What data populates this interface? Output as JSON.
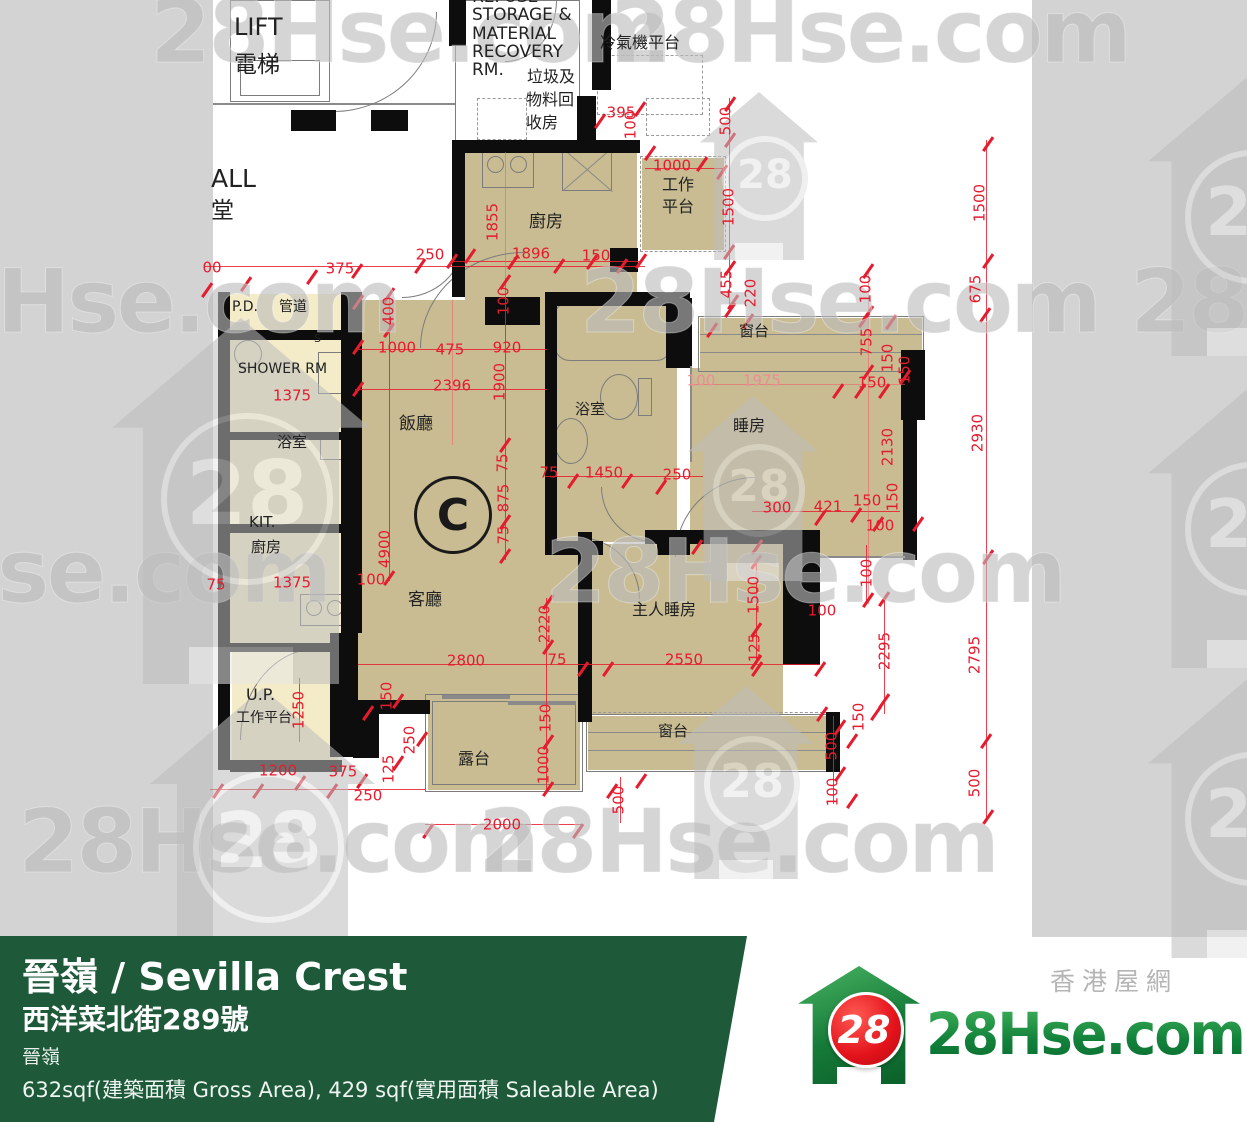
{
  "watermark": {
    "text": "28Hse.com",
    "logo_number": "28"
  },
  "plan": {
    "unit": "C",
    "labels": [
      {
        "t": "LIFT",
        "x": 234,
        "y": 14,
        "s": 24
      },
      {
        "t": "電梯",
        "x": 234,
        "y": 52,
        "s": 23
      },
      {
        "t": "ALL",
        "x": 211,
        "y": 165,
        "s": 25
      },
      {
        "t": "堂",
        "x": 211,
        "y": 198,
        "s": 23
      },
      {
        "t": "REFUSE",
        "x": 472,
        "y": -12,
        "s": 17
      },
      {
        "t": "STORAGE &",
        "x": 472,
        "y": 6,
        "s": 17
      },
      {
        "t": "MATERIAL",
        "x": 472,
        "y": 25,
        "s": 17
      },
      {
        "t": "RECOVERY",
        "x": 472,
        "y": 43,
        "s": 17
      },
      {
        "t": "RM.",
        "x": 472,
        "y": 61,
        "s": 17
      },
      {
        "t": "垃圾及",
        "x": 527,
        "y": 68,
        "s": 16
      },
      {
        "t": "物料回",
        "x": 526,
        "y": 91,
        "s": 16
      },
      {
        "t": "收房",
        "x": 526,
        "y": 114,
        "s": 16
      },
      {
        "t": "冷氣機平台",
        "x": 600,
        "y": 34,
        "s": 16
      },
      {
        "t": "廚房",
        "x": 529,
        "y": 213,
        "s": 17
      },
      {
        "t": "工作",
        "x": 662,
        "y": 176,
        "s": 16
      },
      {
        "t": "平台",
        "x": 662,
        "y": 198,
        "s": 16
      },
      {
        "t": "P.D.",
        "x": 232,
        "y": 299,
        "s": 14
      },
      {
        "t": "管道",
        "x": 279,
        "y": 299,
        "s": 14
      },
      {
        "t": "SHOWER RM",
        "x": 238,
        "y": 361,
        "s": 14
      },
      {
        "t": "浴室",
        "x": 277,
        "y": 434,
        "s": 15
      },
      {
        "t": "KIT.",
        "x": 249,
        "y": 514,
        "s": 15
      },
      {
        "t": "廚房",
        "x": 251,
        "y": 539,
        "s": 15
      },
      {
        "t": "U.P.",
        "x": 246,
        "y": 686,
        "s": 16
      },
      {
        "t": "工作平台",
        "x": 236,
        "y": 710,
        "s": 14
      },
      {
        "t": "飯廳",
        "x": 399,
        "y": 415,
        "s": 17
      },
      {
        "t": "客廳",
        "x": 408,
        "y": 591,
        "s": 17
      },
      {
        "t": "浴室",
        "x": 575,
        "y": 401,
        "s": 15
      },
      {
        "t": "睡房",
        "x": 733,
        "y": 417,
        "s": 16
      },
      {
        "t": "窗台",
        "x": 739,
        "y": 323,
        "s": 15
      },
      {
        "t": "主人睡房",
        "x": 632,
        "y": 601,
        "s": 16
      },
      {
        "t": "窗台",
        "x": 658,
        "y": 723,
        "s": 15
      },
      {
        "t": "露台",
        "x": 458,
        "y": 750,
        "s": 16
      },
      {
        "t": "S",
        "x": 314,
        "y": 333,
        "s": 11
      }
    ],
    "dims": [
      {
        "t": "395",
        "x": 621,
        "y": 113
      },
      {
        "t": "250",
        "x": 430,
        "y": 255
      },
      {
        "t": "1896",
        "x": 531,
        "y": 254
      },
      {
        "t": "150",
        "x": 596,
        "y": 256
      },
      {
        "t": "375",
        "x": 340,
        "y": 269
      },
      {
        "t": "00",
        "x": 212,
        "y": 268
      },
      {
        "t": "1000",
        "x": 672,
        "y": 166
      },
      {
        "t": "1000",
        "x": 397,
        "y": 348
      },
      {
        "t": "475",
        "x": 450,
        "y": 350
      },
      {
        "t": "920",
        "x": 507,
        "y": 348
      },
      {
        "t": "2396",
        "x": 452,
        "y": 386
      },
      {
        "t": "1375",
        "x": 292,
        "y": 396
      },
      {
        "t": "1375",
        "x": 292,
        "y": 583
      },
      {
        "t": "100",
        "x": 371,
        "y": 580
      },
      {
        "t": "100",
        "x": 701,
        "y": 381,
        "lt": 1
      },
      {
        "t": "1975",
        "x": 762,
        "y": 381,
        "lt": 1
      },
      {
        "t": "150",
        "x": 872,
        "y": 383
      },
      {
        "t": "1450",
        "x": 604,
        "y": 473
      },
      {
        "t": "250",
        "x": 677,
        "y": 475
      },
      {
        "t": "75",
        "x": 549,
        "y": 473
      },
      {
        "t": "75",
        "x": 557,
        "y": 660
      },
      {
        "t": "300",
        "x": 777,
        "y": 508
      },
      {
        "t": "421",
        "x": 828,
        "y": 507
      },
      {
        "t": "150",
        "x": 867,
        "y": 501
      },
      {
        "t": "100",
        "x": 880,
        "y": 526
      },
      {
        "t": "2800",
        "x": 466,
        "y": 661
      },
      {
        "t": "2550",
        "x": 684,
        "y": 660
      },
      {
        "t": "100",
        "x": 822,
        "y": 611
      },
      {
        "t": "2000",
        "x": 502,
        "y": 825
      },
      {
        "t": "250",
        "x": 368,
        "y": 796
      },
      {
        "t": "1200",
        "x": 278,
        "y": 771
      },
      {
        "t": "375",
        "x": 343,
        "y": 772
      },
      {
        "t": "75",
        "x": 216,
        "y": 585
      },
      {
        "t": "500",
        "x": 726,
        "y": 121,
        "r": 1
      },
      {
        "t": "1500",
        "x": 729,
        "y": 207,
        "r": 1
      },
      {
        "t": "1855",
        "x": 493,
        "y": 222,
        "r": 1
      },
      {
        "t": "100",
        "x": 504,
        "y": 301,
        "r": 1
      },
      {
        "t": "400",
        "x": 389,
        "y": 311,
        "r": 1
      },
      {
        "t": "1900",
        "x": 500,
        "y": 382,
        "r": 1
      },
      {
        "t": "455",
        "x": 727,
        "y": 284,
        "r": 1
      },
      {
        "t": "220",
        "x": 751,
        "y": 293,
        "r": 1
      },
      {
        "t": "100",
        "x": 866,
        "y": 289,
        "r": 1
      },
      {
        "t": "755",
        "x": 867,
        "y": 342,
        "r": 1
      },
      {
        "t": "150",
        "x": 888,
        "y": 358,
        "r": 1
      },
      {
        "t": "150",
        "x": 905,
        "y": 370,
        "r": 1
      },
      {
        "t": "2130",
        "x": 888,
        "y": 447,
        "r": 1
      },
      {
        "t": "75",
        "x": 503,
        "y": 463,
        "r": 1
      },
      {
        "t": "875",
        "x": 504,
        "y": 498,
        "r": 1
      },
      {
        "t": "75",
        "x": 504,
        "y": 535,
        "r": 1
      },
      {
        "t": "150",
        "x": 893,
        "y": 497,
        "r": 1
      },
      {
        "t": "4900",
        "x": 385,
        "y": 549,
        "r": 1
      },
      {
        "t": "2220",
        "x": 545,
        "y": 624,
        "r": 1
      },
      {
        "t": "1500",
        "x": 754,
        "y": 595,
        "r": 1
      },
      {
        "t": "100",
        "x": 867,
        "y": 573,
        "r": 1
      },
      {
        "t": "150",
        "x": 387,
        "y": 696,
        "r": 1
      },
      {
        "t": "250",
        "x": 410,
        "y": 740,
        "r": 1
      },
      {
        "t": "125",
        "x": 389,
        "y": 769,
        "r": 1
      },
      {
        "t": "150",
        "x": 546,
        "y": 718,
        "r": 1
      },
      {
        "t": "1000",
        "x": 544,
        "y": 765,
        "r": 1
      },
      {
        "t": "500",
        "x": 619,
        "y": 800,
        "r": 1
      },
      {
        "t": "1250",
        "x": 299,
        "y": 710,
        "r": 1
      },
      {
        "t": "125",
        "x": 755,
        "y": 648,
        "r": 1
      },
      {
        "t": "100",
        "x": 631,
        "y": 125,
        "r": 1
      },
      {
        "t": "2930",
        "x": 978,
        "y": 433,
        "r": 1
      },
      {
        "t": "1500",
        "x": 980,
        "y": 203,
        "r": 1
      },
      {
        "t": "675",
        "x": 976,
        "y": 289,
        "r": 1
      },
      {
        "t": "2795",
        "x": 975,
        "y": 655,
        "r": 1
      },
      {
        "t": "500",
        "x": 975,
        "y": 783,
        "r": 1
      },
      {
        "t": "2295",
        "x": 885,
        "y": 651,
        "r": 1
      },
      {
        "t": "150",
        "x": 859,
        "y": 717,
        "r": 1
      },
      {
        "t": "500",
        "x": 832,
        "y": 746,
        "r": 1
      },
      {
        "t": "100",
        "x": 833,
        "y": 792,
        "r": 1
      }
    ]
  },
  "banner": {
    "title": "晉嶺 / Sevilla Crest",
    "address": "西洋菜北街289號",
    "estate": "晉嶺",
    "area": "632sqf(建築面積 Gross Area), 429 sqf(實用面積 Saleable Area)"
  },
  "logo": {
    "number": "28",
    "site": "28Hse.com",
    "tagline": "香港屋網"
  },
  "colors": {
    "banner_green": "#1e5a3a",
    "dim_red": "#e51b2e",
    "room_tan": "#c9bc92",
    "room_cream": "#f4ecc9",
    "strip_gray": "#d3d3d3"
  }
}
